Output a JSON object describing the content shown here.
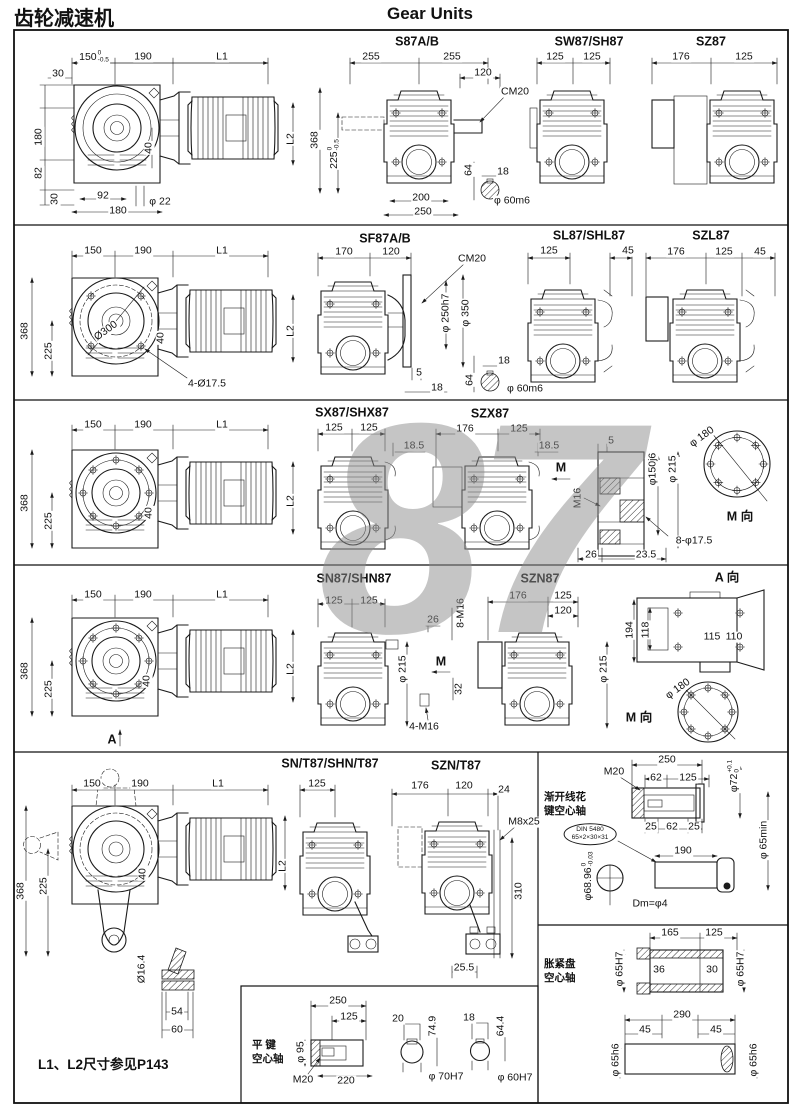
{
  "header": {
    "title_cn": "齿轮减速机",
    "title_en": "Gear Units"
  },
  "watermark": "87",
  "r1": {
    "left": {
      "w1": "150",
      "w1t": "0",
      "w1b": "-0.5",
      "w2": "190",
      "w3": "L1",
      "s1": "30",
      "s2": "180",
      "s3": "82",
      "s4": "30",
      "b1": "92",
      "b2": "180",
      "b3": "φ 22",
      "i1": "40",
      "i2": "L2"
    },
    "s87": {
      "title": "S87A/B",
      "w1": "255",
      "w2": "255",
      "w3": "120",
      "cm": "CM20",
      "v1": "368",
      "v2": "225",
      "v2t": "0",
      "v2b": "-0.5",
      "b1": "200",
      "b2": "250"
    },
    "shaft": {
      "d1": "64",
      "d2": "18",
      "d3": "φ 60m6"
    },
    "sw87": {
      "title": "SW87/SH87",
      "w1": "125",
      "w2": "125"
    },
    "sz87": {
      "title": "SZ87",
      "w1": "176",
      "w2": "125"
    }
  },
  "r2": {
    "left": {
      "w1": "150",
      "w2": "190",
      "w3": "L1",
      "v1": "368",
      "v2": "225",
      "d1": "Ø300",
      "i1": "40",
      "i2": "L2",
      "b1": "4-Ø17.5"
    },
    "sf87": {
      "title": "SF87A/B",
      "w1": "170",
      "w2": "120",
      "cm": "CM20",
      "v1": "φ 250h7",
      "v2": "φ 350",
      "b1": "5",
      "b2": "18"
    },
    "shaft": {
      "d1": "18",
      "d2": "64",
      "d3": "φ 60m6"
    },
    "sl87": {
      "title": "SL87/SHL87",
      "w1": "125",
      "w2": "45"
    },
    "szl87": {
      "title": "SZL87",
      "w1": "176",
      "w2": "125",
      "w3": "45"
    }
  },
  "r3": {
    "left": {
      "w1": "150",
      "w2": "190",
      "w3": "L1",
      "v1": "368",
      "v2": "225",
      "i1": "40",
      "i2": "L2"
    },
    "sx87": {
      "title": "SX87/SHX87",
      "w1": "125",
      "w2": "125",
      "r1": "18.5"
    },
    "szx87": {
      "title": "SZX87",
      "w1": "176",
      "w2": "125",
      "r1": "18.5"
    },
    "sec": {
      "d1": "5",
      "v1": "φ150j6",
      "v2": "φ 215",
      "v3": "M16",
      "m": "M",
      "b1": "26",
      "b2": "23.5",
      "l1": "8-φ17.5"
    },
    "flange": {
      "d1": "φ 180",
      "d2": "M 向"
    }
  },
  "r4": {
    "left": {
      "w1": "150",
      "w2": "190",
      "w3": "L1",
      "v1": "368",
      "v2": "225",
      "i1": "40",
      "i2": "L2",
      "a": "A"
    },
    "sn87": {
      "title": "SN87/SHN87",
      "w1": "125",
      "w2": "125",
      "d1": "26",
      "v1": "8-M16",
      "v2": "φ 215",
      "m": "M",
      "v3": "32",
      "b1": "4-M16"
    },
    "szn87": {
      "title": "SZN87",
      "w1": "176",
      "w2": "125",
      "w3": "120",
      "v1": "φ 215"
    },
    "aview": {
      "title": "A 向",
      "v1": "194",
      "v2": "118",
      "d1": "115",
      "d2": "110"
    },
    "mview": {
      "d1": "φ 180",
      "title": "M 向"
    }
  },
  "r5": {
    "left": {
      "w1": "150",
      "w2": "190",
      "w3": "L1",
      "v1": "368",
      "v2": "225",
      "i1": "40",
      "i2": "L2",
      "v3": "Ø16.4",
      "b1": "54",
      "b2": "60"
    },
    "note": "L1、L2尺寸参见P143",
    "snt": {
      "title": "SN/T87/SHN/T87",
      "w1": "125"
    },
    "sznt": {
      "title": "SZN/T87",
      "w1": "176",
      "w2": "120",
      "w3": "24",
      "l1": "M8x25",
      "v1": "310",
      "b1": "25.5"
    }
  },
  "spline": {
    "cn1": "渐开线花",
    "cn2": "键空心轴",
    "m20": "M20",
    "w1": "250",
    "w2": "62",
    "w3": "125",
    "v1": "φ72",
    "v1t": "+0.1",
    "v1b": "0",
    "b1": "25",
    "b2": "62",
    "b3": "25",
    "din1": "DIN 5480",
    "din2": "65×2×30×31",
    "w4": "190",
    "v2": "φ 65min",
    "v3": "φ68.96",
    "v3t": "0",
    "v3b": "-0.03",
    "dm": "Dm=φ4"
  },
  "shrink": {
    "cn1": "胀紧盘",
    "cn2": "空心轴",
    "w1": "165",
    "w2": "125",
    "v1": "φ 65H7",
    "d1": "36",
    "d2": "30",
    "v2": "φ 65H7",
    "w3": "290",
    "w4": "45",
    "w5": "45",
    "v3": "φ 65h6",
    "v4": "φ 65h6"
  },
  "key": {
    "cn1": "平 键",
    "cn2": "空心轴",
    "w1": "250",
    "w2": "125",
    "v1": "φ 95",
    "m20": "M20",
    "b1": "220",
    "d1": "20",
    "v2": "74.9",
    "c1": "φ 70H7",
    "d2": "18",
    "v3": "64.4",
    "c2": "φ 60H7"
  }
}
